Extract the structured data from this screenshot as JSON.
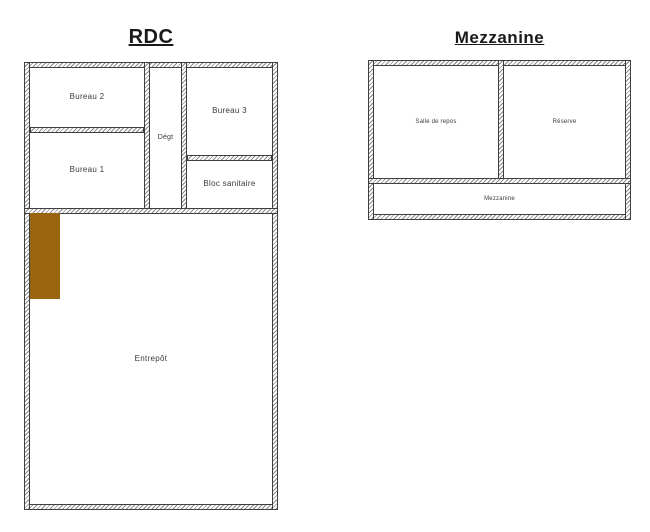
{
  "plans": {
    "rdc": {
      "title": "RDC",
      "rooms": {
        "bureau2": "Bureau 2",
        "bureau1": "Bureau 1",
        "bureau3": "Bureau 3",
        "degt": "Dégt",
        "bloc_sanitaire": "Bloc sanitaire",
        "entrepot": "Entrepôt"
      }
    },
    "mezzanine": {
      "title": "Mezzanine",
      "rooms": {
        "salle_de_repos": "Salle de repos",
        "reserve": "Réserve",
        "mezzanine": "Mezzanine"
      }
    }
  },
  "colors": {
    "background": "#ffffff",
    "wall_line": "#3f3f3f",
    "door_marker": "#99660f",
    "label_text": "#3a3a3a"
  }
}
